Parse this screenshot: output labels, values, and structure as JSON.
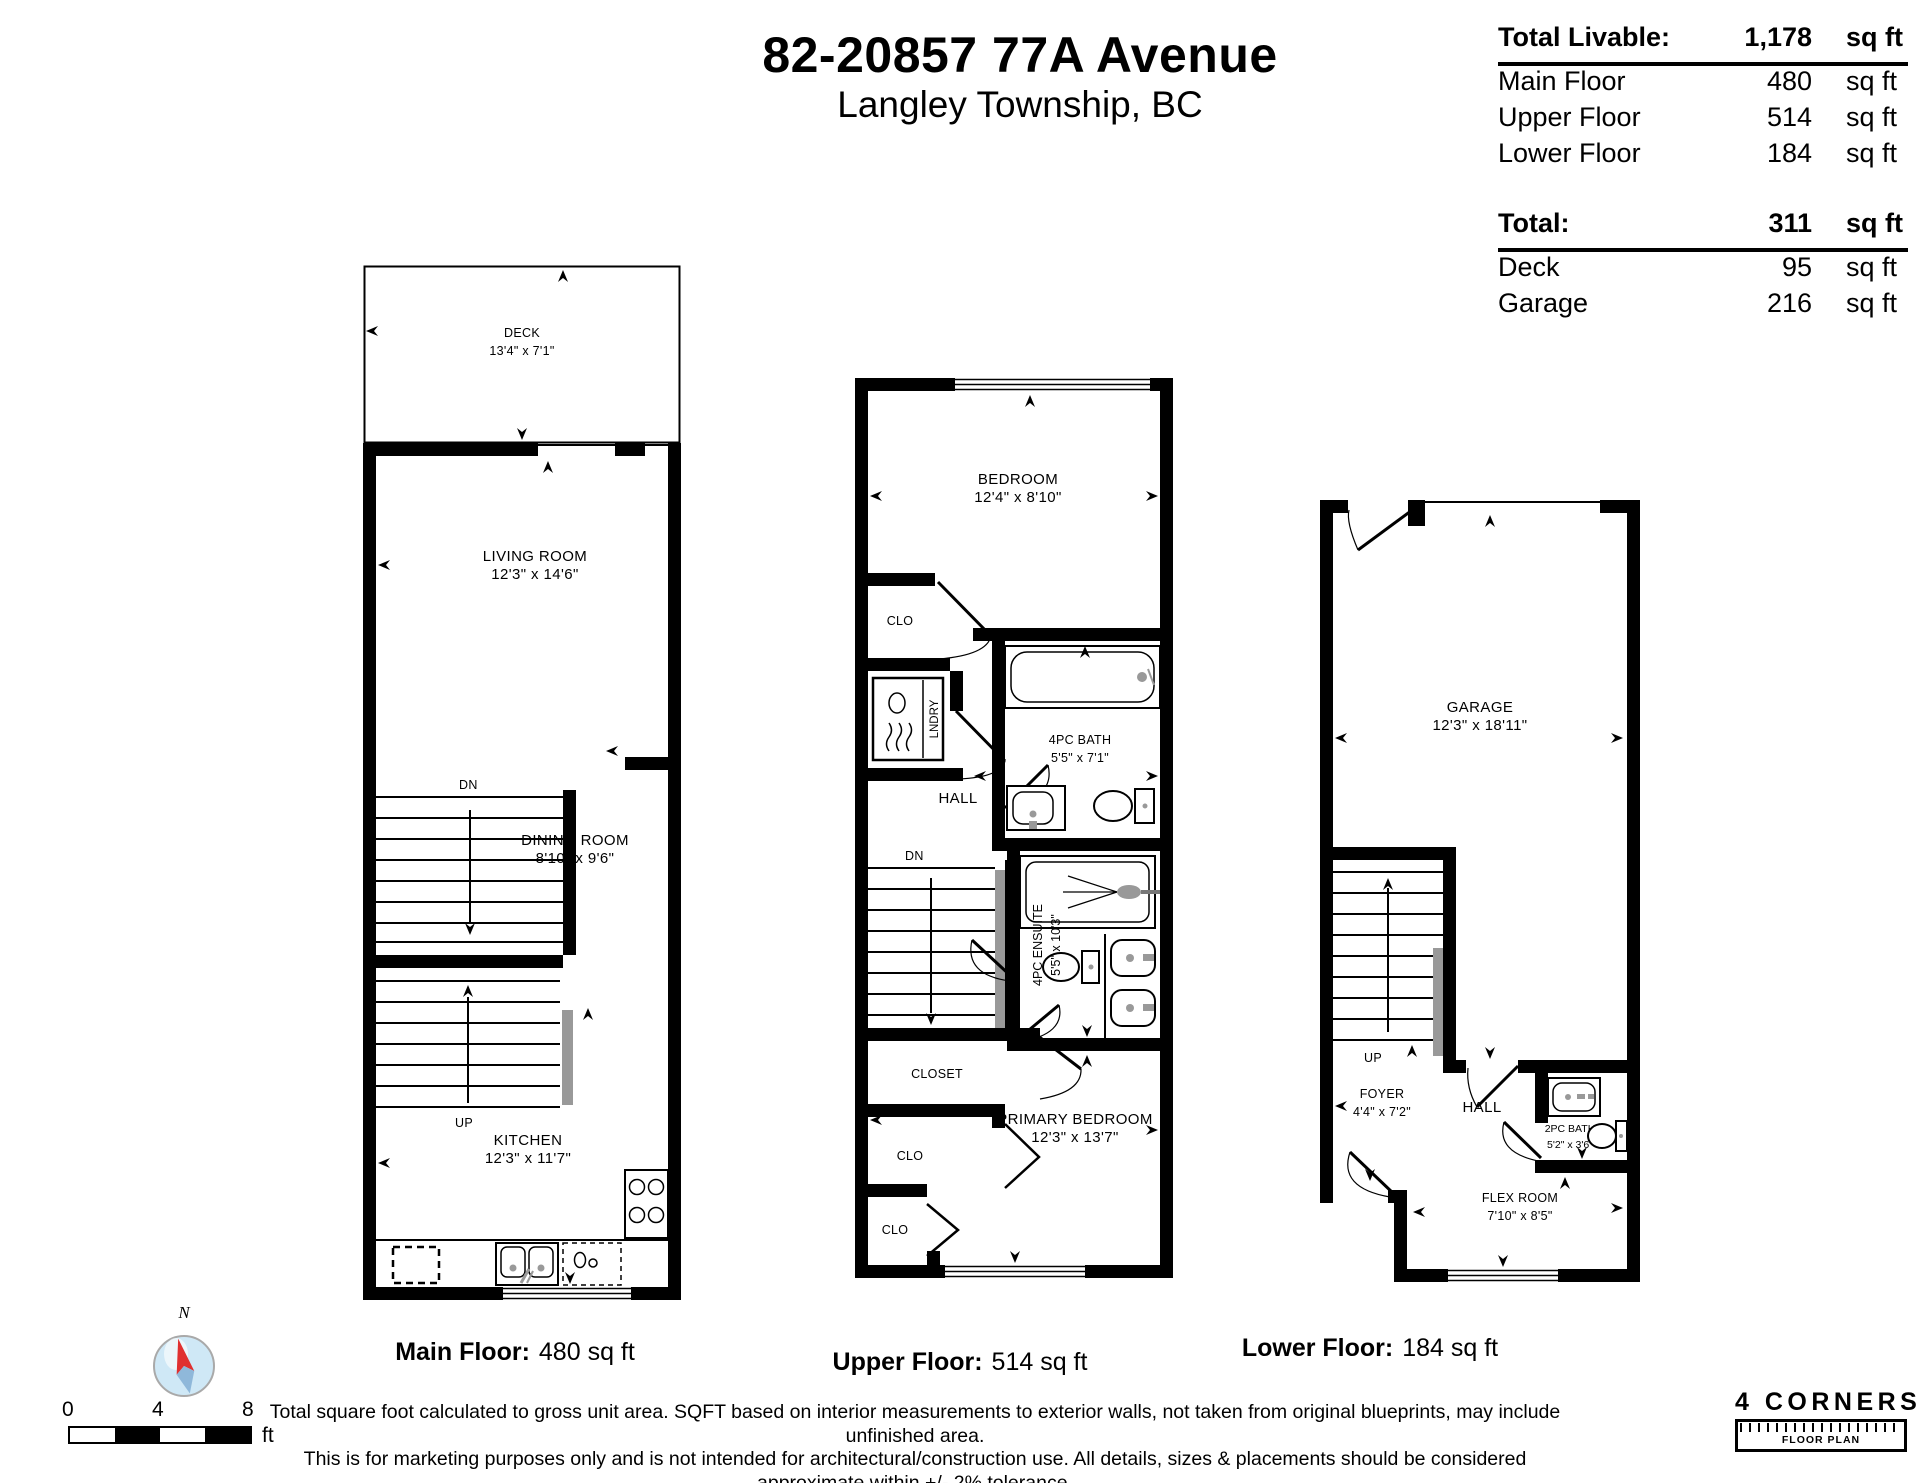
{
  "title": {
    "line1": "82-20857 77A Avenue",
    "line2": "Langley Township, BC"
  },
  "summary": {
    "livable": {
      "label": "Total Livable:",
      "value": "1,178",
      "unit": "sq ft",
      "rows": [
        {
          "label": "Main Floor",
          "value": "480",
          "unit": "sq ft"
        },
        {
          "label": "Upper Floor",
          "value": "514",
          "unit": "sq ft"
        },
        {
          "label": "Lower Floor",
          "value": "184",
          "unit": "sq ft"
        }
      ]
    },
    "other": {
      "label": "Total:",
      "value": "311",
      "unit": "sq ft",
      "rows": [
        {
          "label": "Deck",
          "value": "95",
          "unit": "sq ft"
        },
        {
          "label": "Garage",
          "value": "216",
          "unit": "sq ft"
        }
      ]
    }
  },
  "plans": {
    "main": {
      "caption_label": "Main Floor:",
      "caption_value": "480 sq ft",
      "rooms": {
        "deck": {
          "name": "DECK",
          "dims": "13'4\" x 7'1\""
        },
        "living": {
          "name": "LIVING ROOM",
          "dims": "12'3\" x 14'6\""
        },
        "dining": {
          "name": "DINING ROOM",
          "dims": "8'10\" x 9'6\""
        },
        "kitchen": {
          "name": "KITCHEN",
          "dims": "12'3\" x 11'7\""
        },
        "dn": "DN",
        "up": "UP"
      }
    },
    "upper": {
      "caption_label": "Upper Floor:",
      "caption_value": "514 sq ft",
      "rooms": {
        "bedroom": {
          "name": "BEDROOM",
          "dims": "12'4\" x 8'10\""
        },
        "clo1": "CLO",
        "lndry": "LNDRY",
        "bath": {
          "name": "4PC BATH",
          "dims": "5'5\" x 7'1\""
        },
        "hall": "HALL",
        "dn": "DN",
        "ensuite": {
          "name": "4PC ENSUITE",
          "dims": "5'5\" x 10'3\""
        },
        "closet": "CLOSET",
        "clo2": "CLO",
        "primary": {
          "name": "PRIMARY BEDROOM",
          "dims": "12'3\" x 13'7\""
        },
        "clo3": "CLO"
      }
    },
    "lower": {
      "caption_label": "Lower Floor:",
      "caption_value": "184 sq ft",
      "rooms": {
        "garage": {
          "name": "GARAGE",
          "dims": "12'3\" x 18'11\""
        },
        "up": "UP",
        "hall": "HALL",
        "foyer": {
          "name": "FOYER",
          "dims": "4'4\" x 7'2\""
        },
        "bath": {
          "name": "2PC BATH",
          "dims": "5'2\" x 3'6\""
        },
        "flex": {
          "name": "FLEX ROOM",
          "dims": "7'10\" x 8'5\""
        }
      }
    }
  },
  "compass": {
    "north": "N"
  },
  "scale": {
    "t0": "0",
    "t1": "4",
    "t2": "8",
    "unit": "ft"
  },
  "disclaimer": {
    "line1": "Total square foot calculated to gross unit area. SQFT based on interior measurements to exterior walls, not taken from original blueprints, may include unfinished area.",
    "line2": "This is for marketing purposes only and is not intended for architectural/construction use.  All details, sizes & placements should be considered approximate within +/- 2%  tolerance."
  },
  "logo": {
    "name": "4 CORNERS",
    "subtitle": "FLOOR PLAN"
  }
}
